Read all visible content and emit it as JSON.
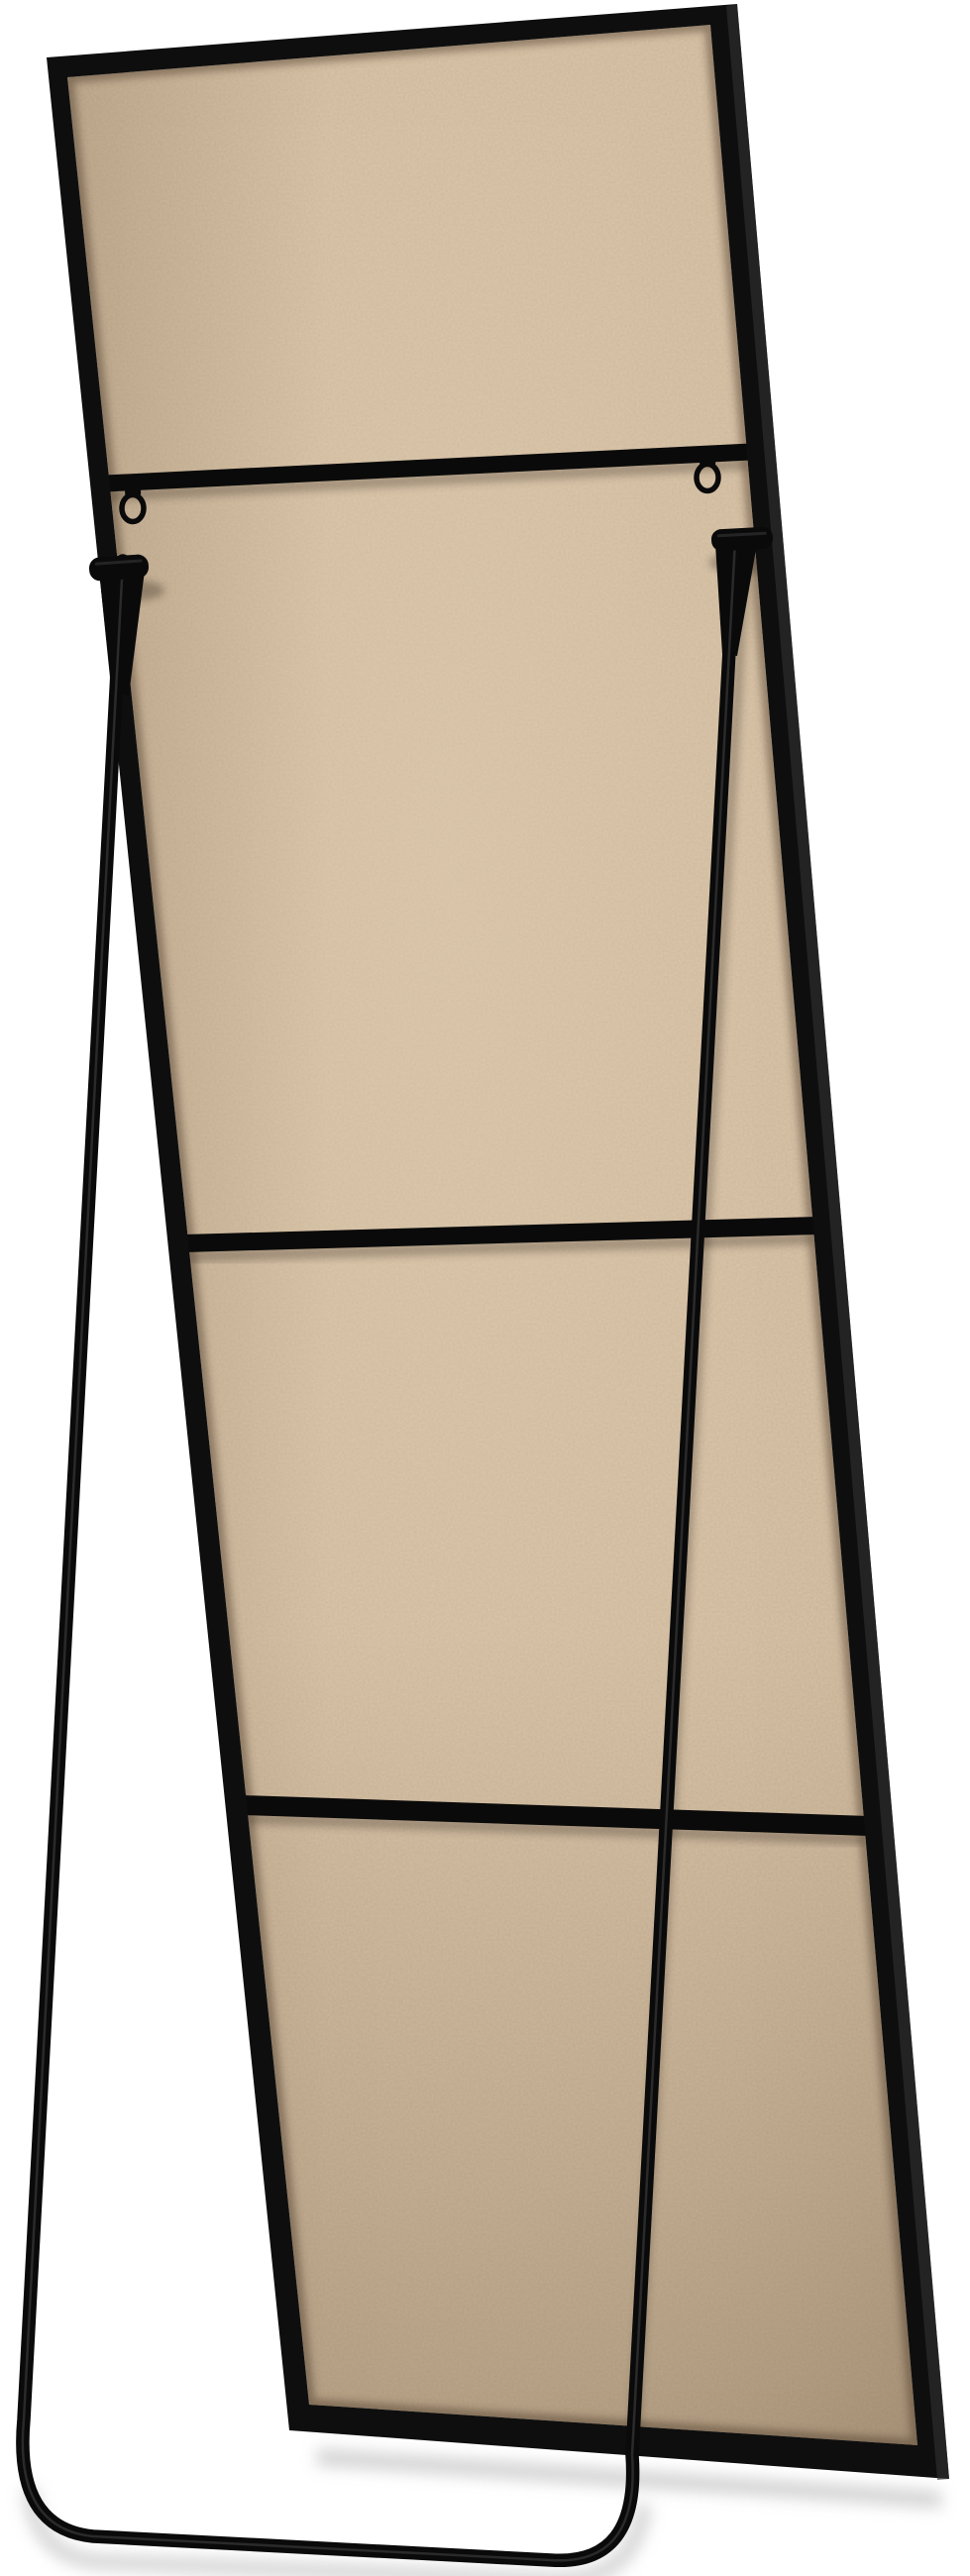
{
  "scene": {
    "kind": "product-photo",
    "subject": "Rear view of a free-standing full-length floor mirror with black metal frame, hardboard back panel and fold-out U-shaped easel stand",
    "background": "#ffffff"
  },
  "colors": {
    "background": "#ffffff",
    "frame": "#0e0e0e",
    "frame_edge_highlight": "#303030",
    "backing_base": "#cbb497",
    "backing_light": "#e4d1b5",
    "backing_dark": "#6d5940",
    "backing_seam": "#53412d",
    "metal": "#0a0a0a",
    "metal_highlight": "#4a4a4a",
    "contact_shadow": "#33271a",
    "floor_shadow": "#a0a0a0"
  },
  "components": {
    "frame": "black metal mirror frame",
    "backing": "tan hardboard back panel",
    "crossbar_top": "top support crossbar",
    "crossbar_middle": "middle support crossbar",
    "crossbar_lower": "lower support crossbar",
    "d_ring_left": "left D-ring hanger",
    "d_ring_right": "right D-ring hanger",
    "hinge_left": "left stand hinge bracket",
    "hinge_right": "right stand hinge bracket",
    "stand": "U-shaped easel stand tube",
    "floor": "white studio floor"
  }
}
